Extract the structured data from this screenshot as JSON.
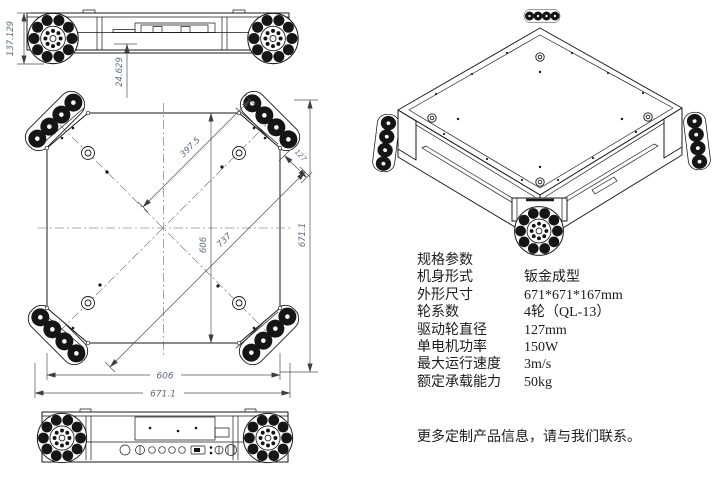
{
  "colors": {
    "line": "#1a1a1a",
    "dim_text": "#5b6b7f",
    "background": "#ffffff"
  },
  "front_view": {
    "dim_height": "137.129",
    "dim_ground": "24.629"
  },
  "top_view": {
    "dim_diag_half": "397.5",
    "dim_diag_full": "737",
    "dim_wheel": "127",
    "dim_inner_v": "606",
    "dim_overall_v": "671.1",
    "dim_inner_h": "606",
    "dim_overall_h": "671.1"
  },
  "specs": {
    "title": "规格参数",
    "rows": [
      {
        "label": "机身形式",
        "value": "钣金成型"
      },
      {
        "label": "外形尺寸",
        "value": "671*671*167mm"
      },
      {
        "label": "轮系数",
        "value": "4轮（QL-13）"
      },
      {
        "label": "驱动轮直径",
        "value": "127mm"
      },
      {
        "label": "单电机功率",
        "value": "150W"
      },
      {
        "label": "最大运行速度",
        "value": "3m/s"
      },
      {
        "label": "额定承载能力",
        "value": "50kg"
      }
    ],
    "note": "更多定制产品信息，请与我们联系。"
  }
}
